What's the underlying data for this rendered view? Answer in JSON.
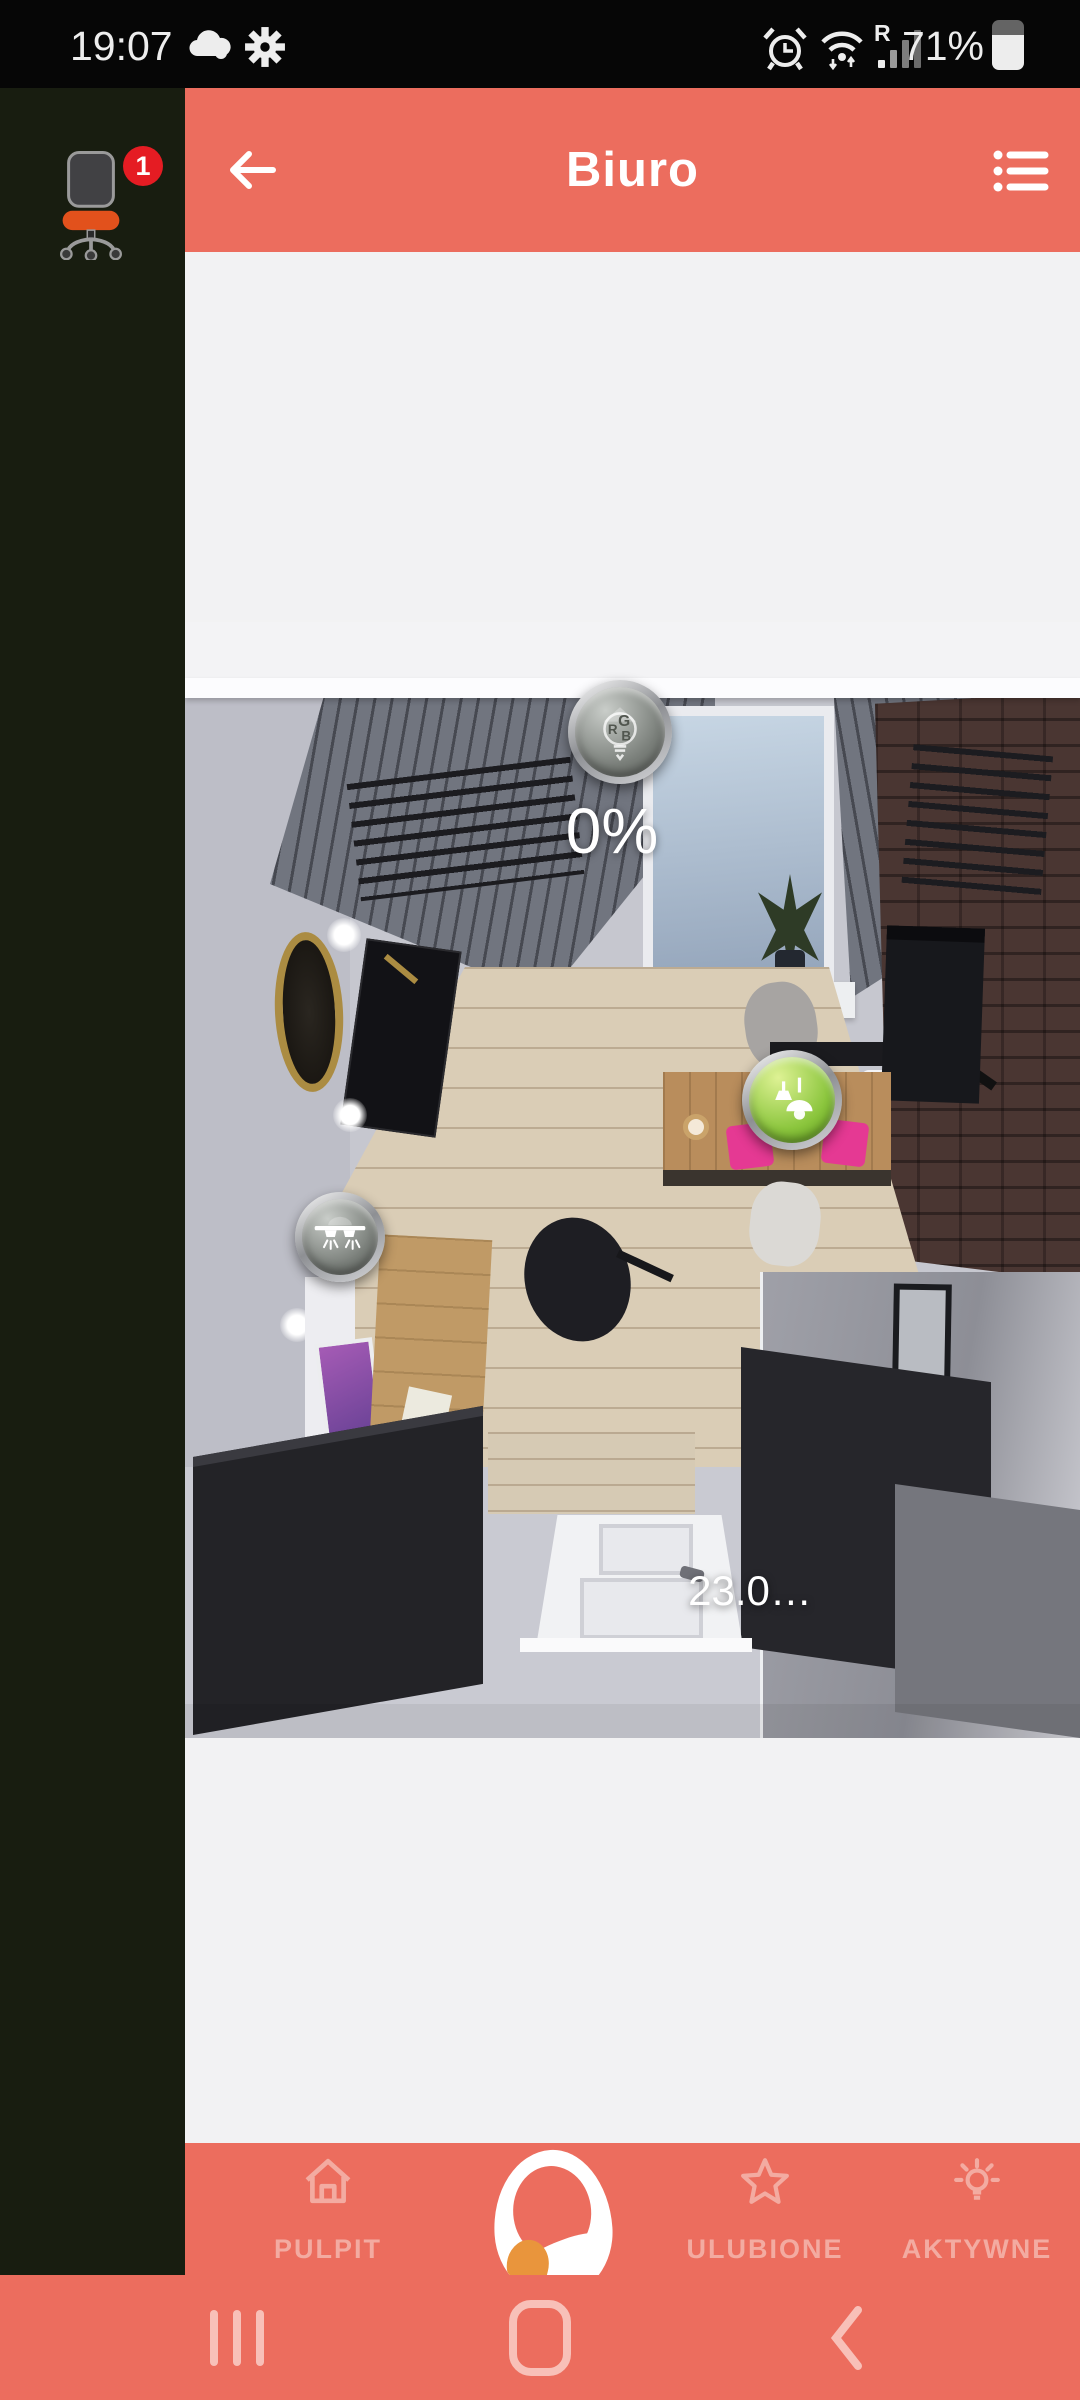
{
  "status_bar": {
    "time": "19:07",
    "battery_percent": "71%",
    "roaming_label": "R",
    "icons": {
      "left": [
        "cloud-icon",
        "settings-gear-icon"
      ],
      "right": [
        "alarm-clock-icon",
        "wifi-icon",
        "signal-bars-icon",
        "battery-icon"
      ]
    }
  },
  "sidebar": {
    "icon": "office-chair-icon",
    "notification_count": "1"
  },
  "app_bar": {
    "title": "Biuro",
    "back_icon": "back-arrow-icon",
    "menu_icon": "list-menu-icon"
  },
  "room_view": {
    "description": "3D top-down render of the office room",
    "blind_level": "0%",
    "temperature": "23.0…",
    "rgb_letters": {
      "r": "R",
      "g": "G",
      "b": "B"
    },
    "controls": [
      {
        "name": "rgb-light-button",
        "icon": "rgb-bulb-icon",
        "value": "0%",
        "state": "off"
      },
      {
        "name": "pendant-light-button",
        "icon": "pendant-lamps-icon",
        "state": "on",
        "state_color": "#8cc63e"
      },
      {
        "name": "ceiling-light-button",
        "icon": "ceiling-lights-icon",
        "state": "off"
      }
    ]
  },
  "bottom_nav": {
    "items": [
      {
        "label": "PULPIT",
        "icon": "home-icon"
      },
      {
        "label": "ULUBIONE",
        "icon": "star-icon"
      },
      {
        "label": "AKTYWNE",
        "icon": "bulb-icon"
      }
    ],
    "logo_icon": "app-logo"
  },
  "android_nav": {
    "icons": [
      "recents-icon",
      "home-icon",
      "back-icon"
    ]
  },
  "colors": {
    "accent": "#ec6d5e",
    "accent_soft": "#f3aba1",
    "sidebar_bg": "#181d10",
    "status_bar_bg": "#060606",
    "content_bg": "#f2f2f3",
    "badge": "#e51c23",
    "chair_seat": "#e2511c",
    "active_green": "#8cc63e"
  }
}
